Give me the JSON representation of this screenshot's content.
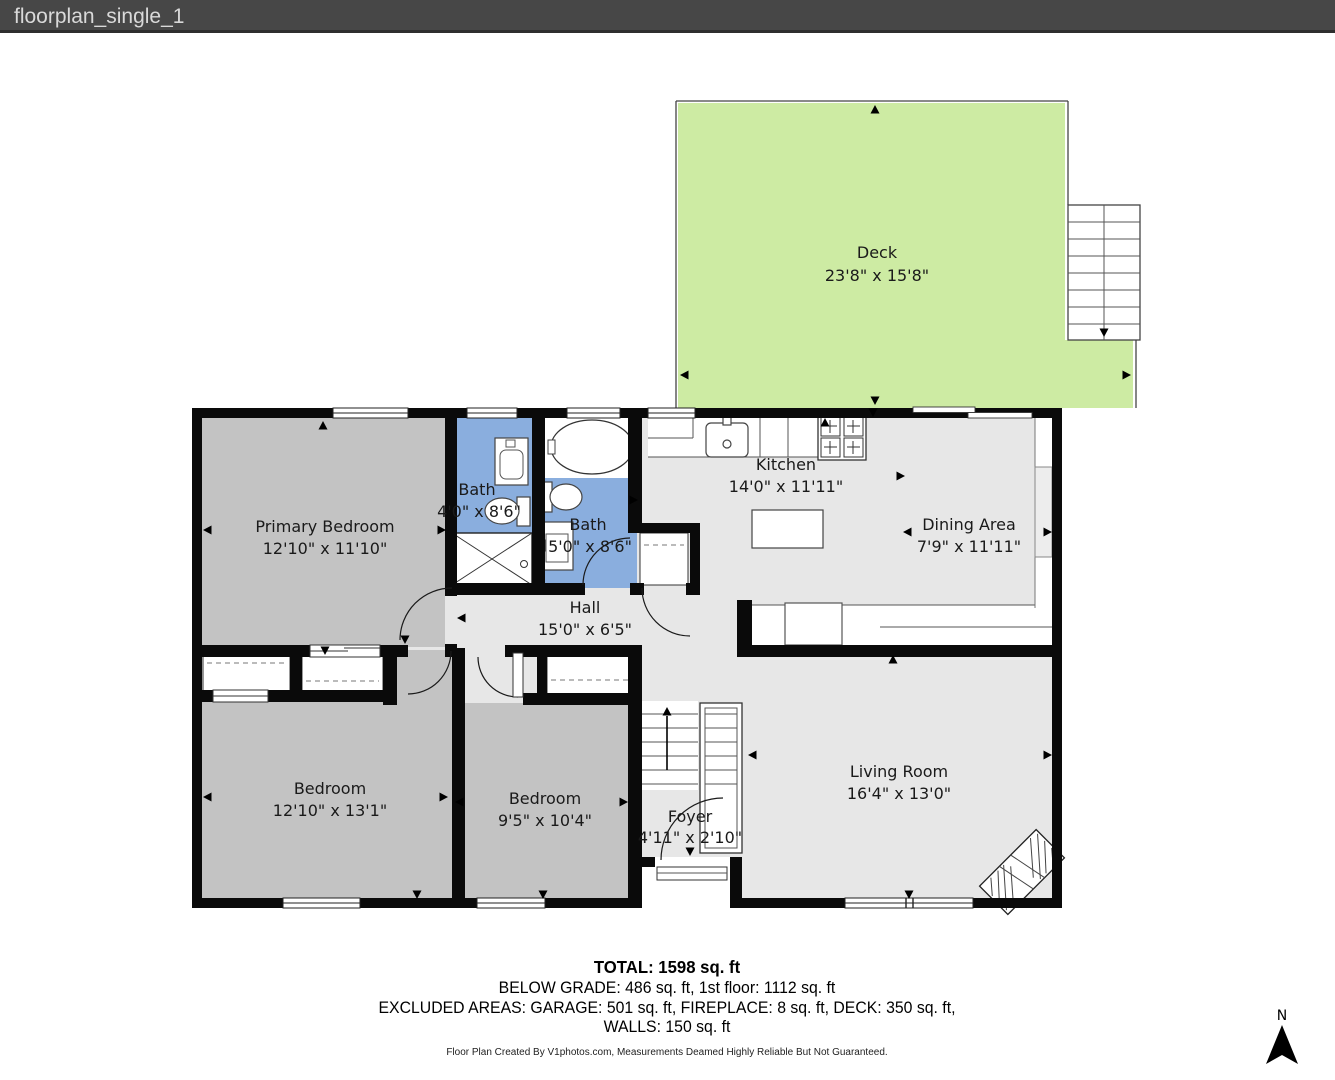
{
  "window": {
    "title": "floorplan_single_1"
  },
  "rooms": {
    "deck": {
      "name": "Deck",
      "dims": "23'8\" x 15'8\""
    },
    "kitchen": {
      "name": "Kitchen",
      "dims": "14'0\" x 11'11\""
    },
    "dining": {
      "name": "Dining Area",
      "dims": "7'9\" x 11'11\""
    },
    "bath_small": {
      "name": "Bath",
      "dims": "4'0\" x 8'6\""
    },
    "bath_main": {
      "name": "Bath",
      "dims": "5'0\" x 8'6\""
    },
    "primary_bedroom": {
      "name": "Primary Bedroom",
      "dims": "12'10\" x 11'10\""
    },
    "hall": {
      "name": "Hall",
      "dims": "15'0\" x 6'5\""
    },
    "bedroom_left": {
      "name": "Bedroom",
      "dims": "12'10\" x 13'1\""
    },
    "bedroom_mid": {
      "name": "Bedroom",
      "dims": "9'5\" x 10'4\""
    },
    "foyer": {
      "name": "Foyer",
      "dims": "4'11\" x 2'10\""
    },
    "living": {
      "name": "Living Room",
      "dims": "16'4\" x 13'0\""
    }
  },
  "summary": {
    "total": "TOTAL: 1598 sq. ft",
    "line2": "BELOW GRADE: 486 sq. ft, 1st floor: 1112 sq. ft",
    "line3": "EXCLUDED AREAS: GARAGE: 501 sq. ft, FIREPLACE: 8 sq. ft, DECK: 350 sq. ft,",
    "line4": "WALLS: 150 sq. ft"
  },
  "footer": {
    "credit": "Floor Plan Created By V1photos.com, Measurements Deamed Highly Reliable But Not Guaranteed."
  },
  "compass": {
    "label": "N"
  },
  "colors": {
    "titlebar_bg": "#474747",
    "wall": "#0a0a0a",
    "floor_light": "#e7e7e7",
    "bedroom_gray": "#c3c3c3",
    "bath_blue": "#8aaede",
    "deck_green": "#cdeba3"
  }
}
